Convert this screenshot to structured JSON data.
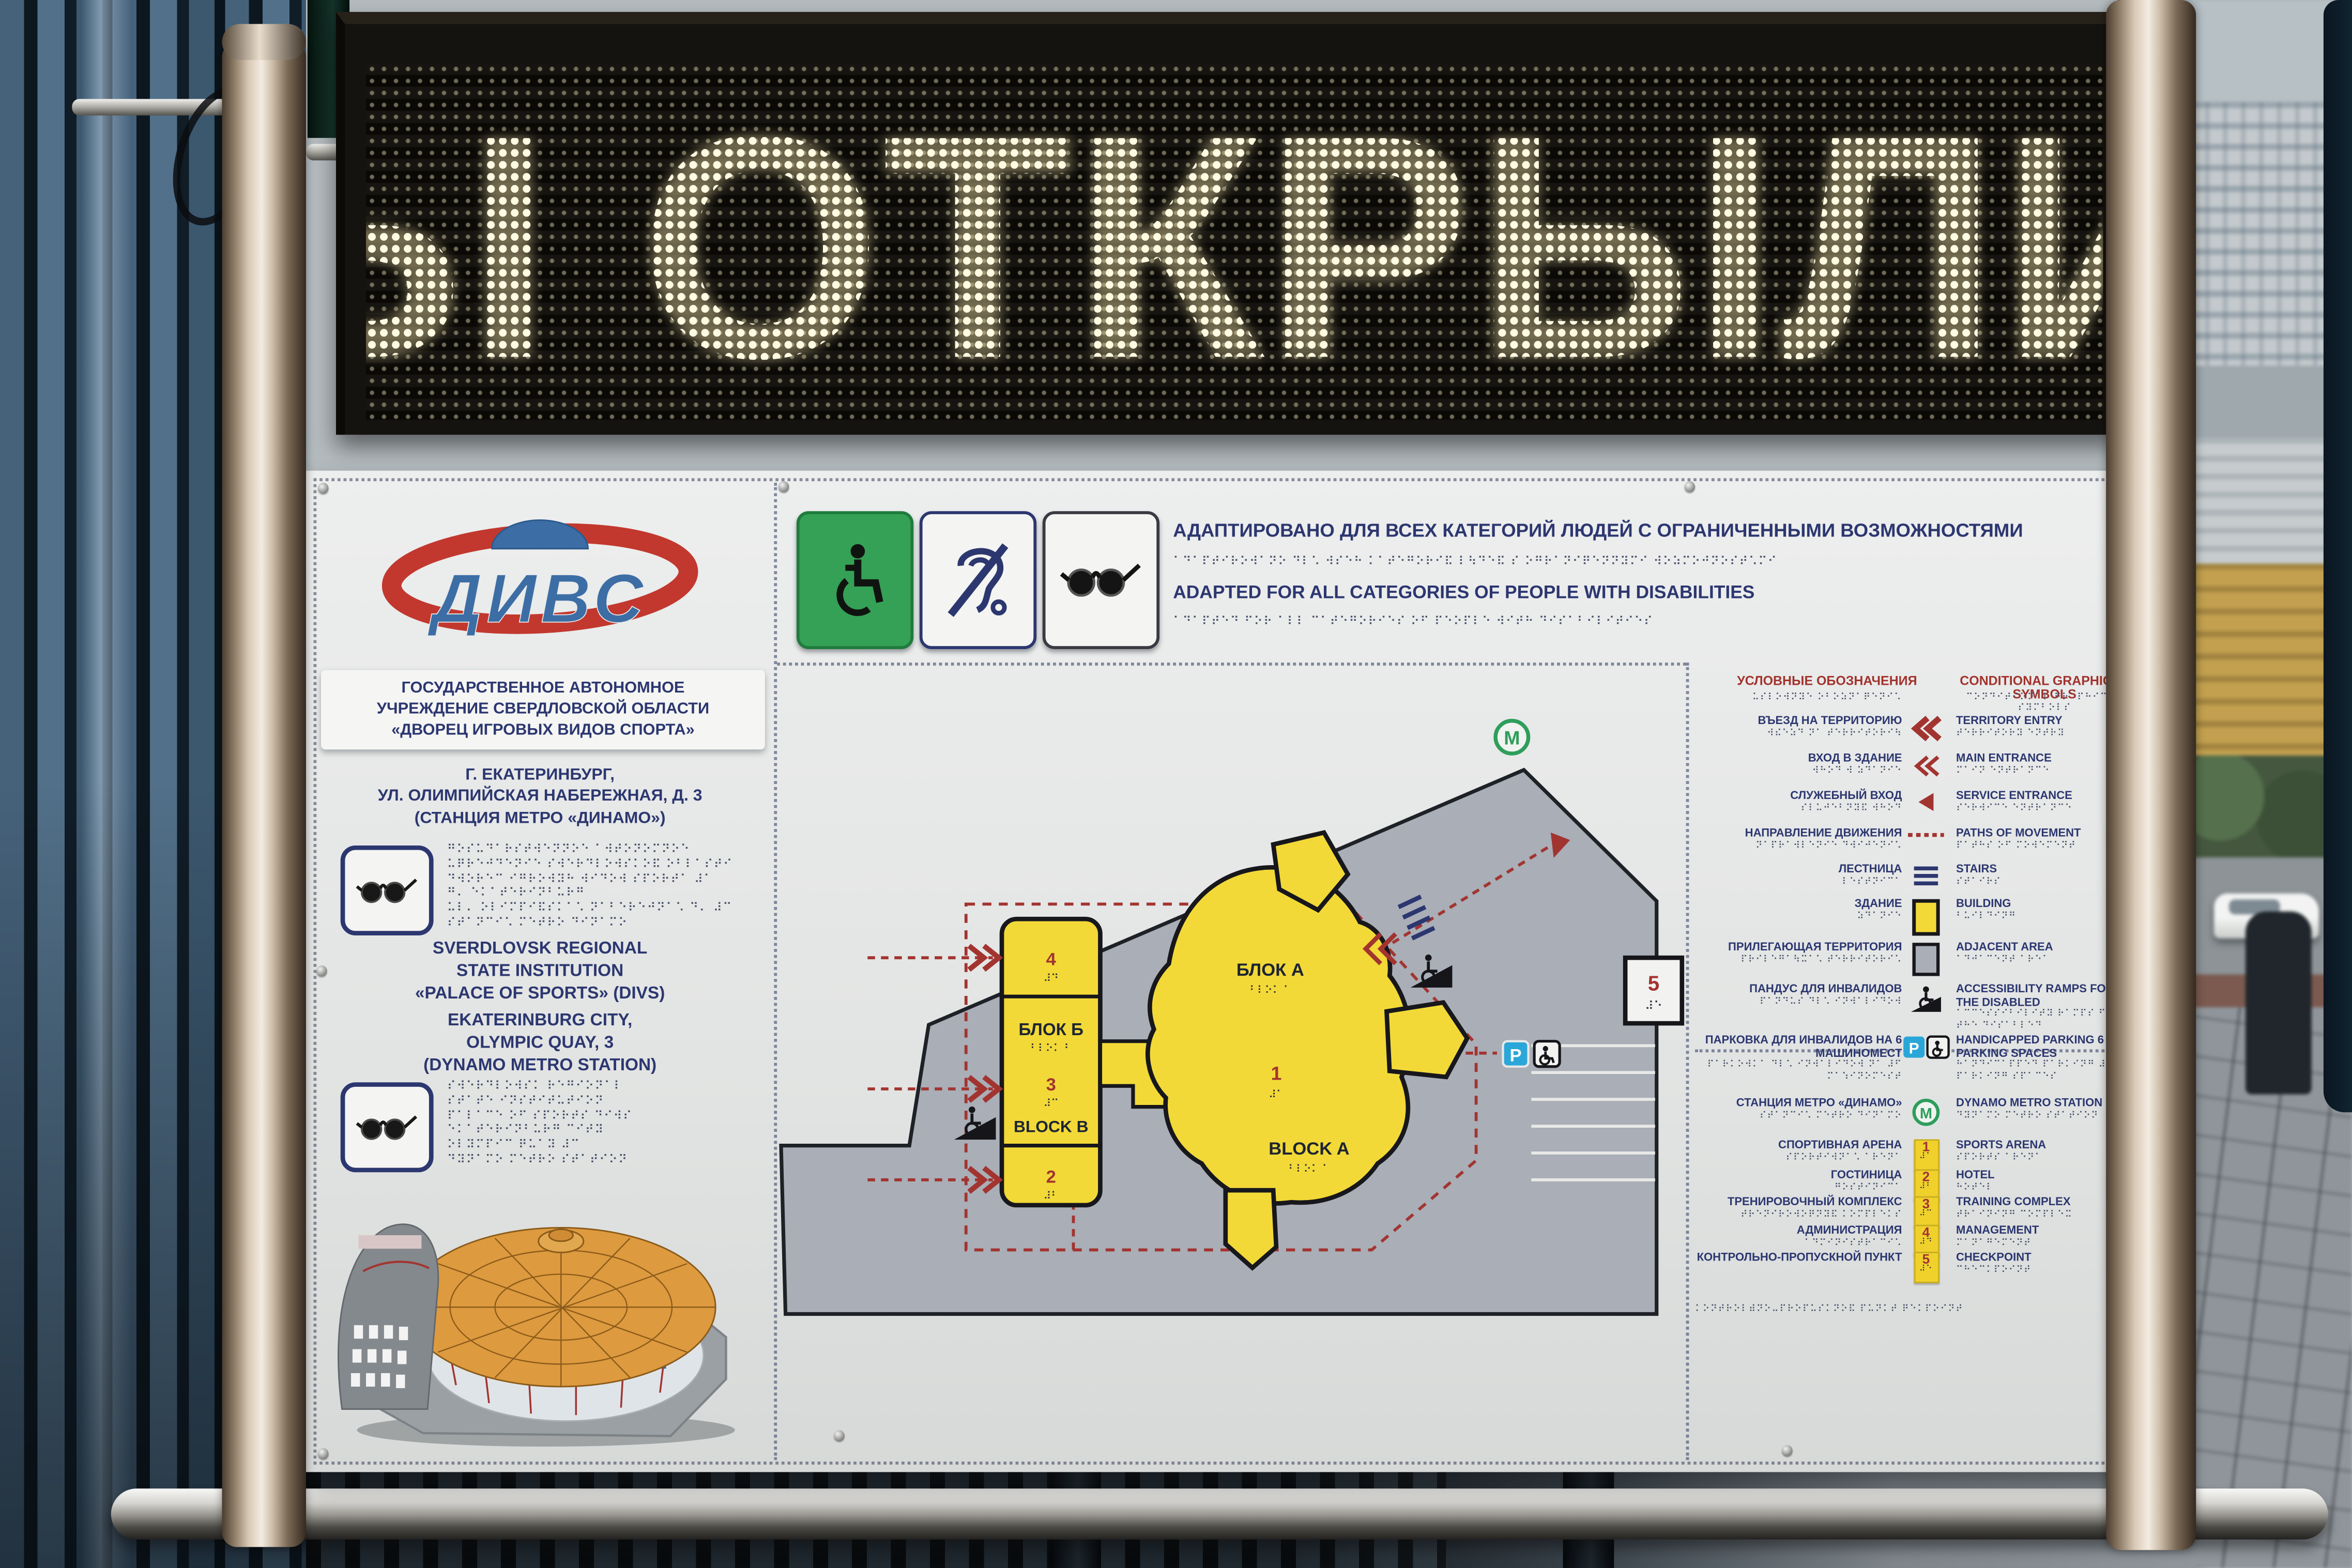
{
  "led": {
    "text": "Ы ОТКРЫЛИ"
  },
  "logo": {
    "text": "ДИВС"
  },
  "org": {
    "ru": [
      "ГОСУДАРСТВЕННОЕ АВТОНОМНОЕ",
      "УЧРЕЖДЕНИЕ СВЕРДЛОВСКОЙ ОБЛАСТИ",
      "«ДВОРЕЦ ИГРОВЫХ ВИДОВ СПОРТА»"
    ],
    "address_ru": [
      "Г. ЕКАТЕРИНБУРГ,",
      "УЛ. ОЛИМПИЙСКАЯ НАБЕРЕЖНАЯ, Д. 3",
      "(СТАНЦИЯ МЕТРО «ДИНАМО»)"
    ],
    "en": [
      "SVERDLOVSK REGIONAL",
      "STATE INSTITUTION",
      "«PALACE OF SPORTS» (DIVS)"
    ],
    "address_en": [
      "EKATERINBURG CITY,",
      "OLYMPIC QUAY, 3",
      "(DYNAMO METRO STATION)"
    ]
  },
  "header": {
    "ru": "АДАПТИРОВАНО ДЛЯ ВСЕХ КАТЕГОРИЙ ЛЮДЕЙ С ОГРАНИЧЕННЫМИ ВОЗМОЖНОСТЯМИ",
    "en": "ADAPTED FOR ALL CATEGORIES OF PEOPLE WITH DISABILITIES",
    "braille_ru": "⠁⠙⠁⠏⠞⠊⠗⠕⠺⠁⠝⠕ ⠙⠇⠡ ⠺⠎⠑⠓ ⠅⠁⠞⠑⠛⠕⠗⠊⠯ ⠇⠳⠙⠑⠯ ⠎ ⠕⠛⠗⠁⠝⠊⠟⠑⠝⠝⠽⠍⠊ ⠺⠕⠵⠍⠕⠚⠝⠕⠎⠞⠡⠍⠊",
    "braille_en": "⠁⠙⠁⠏⠞⠑⠙ ⠋⠕⠗ ⠁⠇⠇ ⠉⠁⠞⠑⠛⠕⠗⠊⠑⠎ ⠕⠋ ⠏⠑⠕⠏⠇⠑ ⠺⠊⠞⠓ ⠙⠊⠎⠁⠃⠊⠇⠊⠞⠊⠑⠎"
  },
  "legend": {
    "title_ru": "УСЛОВНЫЕ ОБОЗНАЧЕНИЯ",
    "title_en": "CONDITIONAL GRAPHICAL SYMBOLS",
    "title_br_ru": "⠥⠎⠇⠕⠺⠝⠽⠑ ⠕⠃⠕⠵⠝⠁⠟⠑⠝⠊⠡",
    "title_br_en": "⠉⠕⠝⠙⠊⠞⠊⠕⠝⠁⠇ ⠛⠗⠁⠏⠓⠊⠉⠁⠇ ⠎⠽⠍⠃⠕⠇⠎",
    "items": [
      {
        "ru": "ВЪЕЗД НА ТЕРРИТОРИЮ",
        "en": "TERRITORY ENTRY",
        "br_ru": "⠺⠮⠑⠵⠙ ⠝⠁ ⠞⠑⠗⠗⠊⠞⠕⠗⠊⠳",
        "br_en": "⠞⠑⠗⠗⠊⠞⠕⠗⠽ ⠑⠝⠞⠗⠽"
      },
      {
        "ru": "ВХОД В ЗДАНИЕ",
        "en": "MAIN ENTRANCE",
        "br_ru": "⠺⠓⠕⠙ ⠺ ⠵⠙⠁⠝⠊⠑",
        "br_en": "⠍⠁⠊⠝ ⠑⠝⠞⠗⠁⠝⠉⠑"
      },
      {
        "ru": "СЛУЖЕБНЫЙ ВХОД",
        "en": "SERVICE ENTRANCE",
        "br_ru": "⠎⠇⠥⠚⠑⠃⠝⠽⠯ ⠺⠓⠕⠙",
        "br_en": "⠎⠑⠗⠺⠊⠉⠑ ⠑⠝⠞⠗⠁⠝⠉⠑"
      },
      {
        "ru": "НАПРАВЛЕНИЕ ДВИЖЕНИЯ",
        "en": "PATHS OF MOVEMENT",
        "br_ru": "⠝⠁⠏⠗⠁⠺⠇⠑⠝⠊⠑ ⠙⠺⠊⠚⠑⠝⠊⠡",
        "br_en": "⠏⠁⠞⠓⠎ ⠕⠋ ⠍⠕⠺⠑⠍⠑⠝⠞"
      },
      {
        "ru": "ЛЕСТНИЦА",
        "en": "STAIRS",
        "br_ru": "⠇⠑⠎⠞⠝⠊⠉⠁",
        "br_en": "⠎⠞⠁⠊⠗⠎"
      },
      {
        "ru": "ЗДАНИЕ",
        "en": "BUILDING",
        "br_ru": "⠵⠙⠁⠝⠊⠑",
        "br_en": "⠃⠥⠊⠇⠙⠊⠝⠛"
      },
      {
        "ru": "ПРИЛЕГАЮЩАЯ ТЕРРИТОРИЯ",
        "en": "ADJACENT AREA",
        "br_ru": "⠏⠗⠊⠇⠑⠛⠁⠳⠭⠁⠡ ⠞⠑⠗⠗⠊⠞⠕⠗⠊⠡",
        "br_en": "⠁⠙⠚⠁⠉⠑⠝⠞ ⠁⠗⠑⠁"
      },
      {
        "ru": "ПАНДУС ДЛЯ ИНВАЛИДОВ",
        "en": "ACCESSIBILITY RAMPS FOR THE DISABLED",
        "br_ru": "⠏⠁⠝⠙⠥⠎ ⠙⠇⠡ ⠊⠝⠺⠁⠇⠊⠙⠕⠺",
        "br_en": "⠁⠉⠉⠑⠎⠎⠊⠃⠊⠇⠊⠞⠽ ⠗⠁⠍⠏⠎ ⠋⠕⠗ ⠞⠓⠑ ⠙⠊⠎⠁⠃⠇⠑⠙"
      },
      {
        "ru": "ПАРКОВКА ДЛЯ ИНВАЛИДОВ НА 6 МАШИНОМЕСТ",
        "en": "HANDICAPPED PARKING 6 PARKING SPACES",
        "br_ru": "⠏⠁⠗⠅⠕⠺⠅⠁ ⠙⠇⠡ ⠊⠝⠺⠁⠇⠊⠙⠕⠺ ⠝⠁ ⠼⠋ ⠍⠁⠱⠊⠝⠕⠍⠑⠎⠞",
        "br_en": "⠓⠁⠝⠙⠊⠉⠁⠏⠏⠑⠙ ⠏⠁⠗⠅⠊⠝⠛ ⠼⠋ ⠏⠁⠗⠅⠊⠝⠛ ⠎⠏⠁⠉⠑⠎"
      },
      {
        "ru": "СТАНЦИЯ МЕТРО «ДИНАМО»",
        "en": "DYNAMO METRO STATION",
        "br_ru": "⠎⠞⠁⠝⠉⠊⠡ ⠍⠑⠞⠗⠕ ⠙⠊⠝⠁⠍⠕",
        "br_en": "⠙⠽⠝⠁⠍⠕ ⠍⠑⠞⠗⠕ ⠎⠞⠁⠞⠊⠕⠝"
      }
    ]
  },
  "facilities": {
    "items": [
      {
        "num": "1",
        "ru": "СПОРТИВНАЯ АРЕНА",
        "en": "SPORTS ARENA",
        "br_ru": "⠎⠏⠕⠗⠞⠊⠺⠝⠁⠡ ⠁⠗⠑⠝⠁",
        "br_en": "⠎⠏⠕⠗⠞⠎ ⠁⠗⠑⠝⠁",
        "br_num": "⠼⠁"
      },
      {
        "num": "2",
        "ru": "ГОСТИНИЦА",
        "en": "HOTEL",
        "br_ru": "⠛⠕⠎⠞⠊⠝⠊⠉⠁",
        "br_en": "⠓⠕⠞⠑⠇",
        "br_num": "⠼⠃"
      },
      {
        "num": "3",
        "ru": "ТРЕНИРОВОЧНЫЙ КОМПЛЕКС",
        "en": "TRAINING COMPLEX",
        "br_ru": "⠞⠗⠑⠝⠊⠗⠕⠺⠕⠟⠝⠽⠯ ⠅⠕⠍⠏⠇⠑⠅⠎",
        "br_en": "⠞⠗⠁⠊⠝⠊⠝⠛ ⠉⠕⠍⠏⠇⠑⠭",
        "br_num": "⠼⠉"
      },
      {
        "num": "4",
        "ru": "АДМИНИСТРАЦИЯ",
        "en": "MANAGEMENT",
        "br_ru": "⠁⠙⠍⠊⠝⠊⠎⠞⠗⠁⠉⠊⠡",
        "br_en": "⠍⠁⠝⠁⠛⠑⠍⠑⠝⠞",
        "br_num": "⠼⠙"
      },
      {
        "num": "5",
        "ru": "КОНТРОЛЬНО-ПРОПУСКНОЙ ПУНКТ",
        "en": "CHECKPOINT",
        "br_ru": "⠅⠕⠝⠞⠗⠕⠇⠾⠝⠕ ⠏⠗⠕⠏⠥⠎⠅⠝⠕⠯",
        "br_en": "⠉⠓⠑⠉⠅⠏⠕⠊⠝⠞",
        "br_num": "⠼⠑"
      }
    ],
    "footer_braille": "⠅⠕⠝⠞⠗⠕⠇⠾⠝⠕⠤⠏⠗⠕⠏⠥⠎⠅⠝⠕⠯ ⠏⠥⠝⠅⠞ ⠟⠑⠅⠏⠕⠊⠝⠞"
  },
  "map": {
    "block_a_ru": "БЛОК А",
    "block_a_en": "BLOCK A",
    "block_a_num": "1",
    "block_b_ru": "БЛОК Б",
    "block_b_en": "BLOCK B",
    "sec_top": "4",
    "sec_mid": "3",
    "sec_bot": "2",
    "checkpoint_num": "5",
    "metro_letter": "M",
    "parking_letter": "P",
    "br": {
      "a": "⠃⠇⠕⠅ ⠁",
      "b": "⠃⠇⠕⠅ ⠃",
      "n1": "⠼⠁",
      "n2": "⠼⠃",
      "n3": "⠼⠉",
      "n4": "⠼⠙",
      "n5": "⠼⠑"
    }
  },
  "braille_blocks": {
    "blk1": [
      "⠛⠕⠎⠥⠙⠁⠗⠎⠞⠺⠑⠝⠝⠕⠑ ⠁⠺⠞⠕⠝⠕⠍⠝⠕⠑",
      "⠥⠟⠗⠑⠚⠙⠑⠝⠊⠑ ⠎⠺⠑⠗⠙⠇⠕⠺⠎⠅⠕⠯ ⠕⠃⠇⠁⠎⠞⠊",
      "⠙⠺⠕⠗⠑⠉ ⠊⠛⠗⠕⠺⠽⠓ ⠺⠊⠙⠕⠺ ⠎⠏⠕⠗⠞⠁ ⠼⠁",
      "⠛⠄ ⠑⠅⠁⠞⠑⠗⠊⠝⠃⠥⠗⠛",
      "⠥⠇⠄ ⠕⠇⠊⠍⠏⠊⠯⠎⠅⠁⠡ ⠝⠁⠃⠑⠗⠑⠚⠝⠁⠡ ⠙⠄ ⠼⠉",
      "⠎⠞⠁⠝⠉⠊⠡ ⠍⠑⠞⠗⠕ ⠙⠊⠝⠁⠍⠕"
    ],
    "blk2": [
      "⠎⠺⠑⠗⠙⠇⠕⠺⠎⠅ ⠗⠑⠛⠊⠕⠝⠁⠇",
      "⠎⠞⠁⠞⠑ ⠊⠝⠎⠞⠊⠞⠥⠞⠊⠕⠝",
      "⠏⠁⠇⠁⠉⠑ ⠕⠋ ⠎⠏⠕⠗⠞⠎ ⠙⠊⠺⠎",
      "⠑⠅⠁⠞⠑⠗⠊⠝⠃⠥⠗⠛ ⠉⠊⠞⠽",
      "⠕⠇⠽⠍⠏⠊⠉ ⠟⠥⠁⠽ ⠼⠉",
      "⠙⠽⠝⠁⠍⠕ ⠍⠑⠞⠗⠕ ⠎⠞⠁⠞⠊⠕⠝"
    ]
  }
}
